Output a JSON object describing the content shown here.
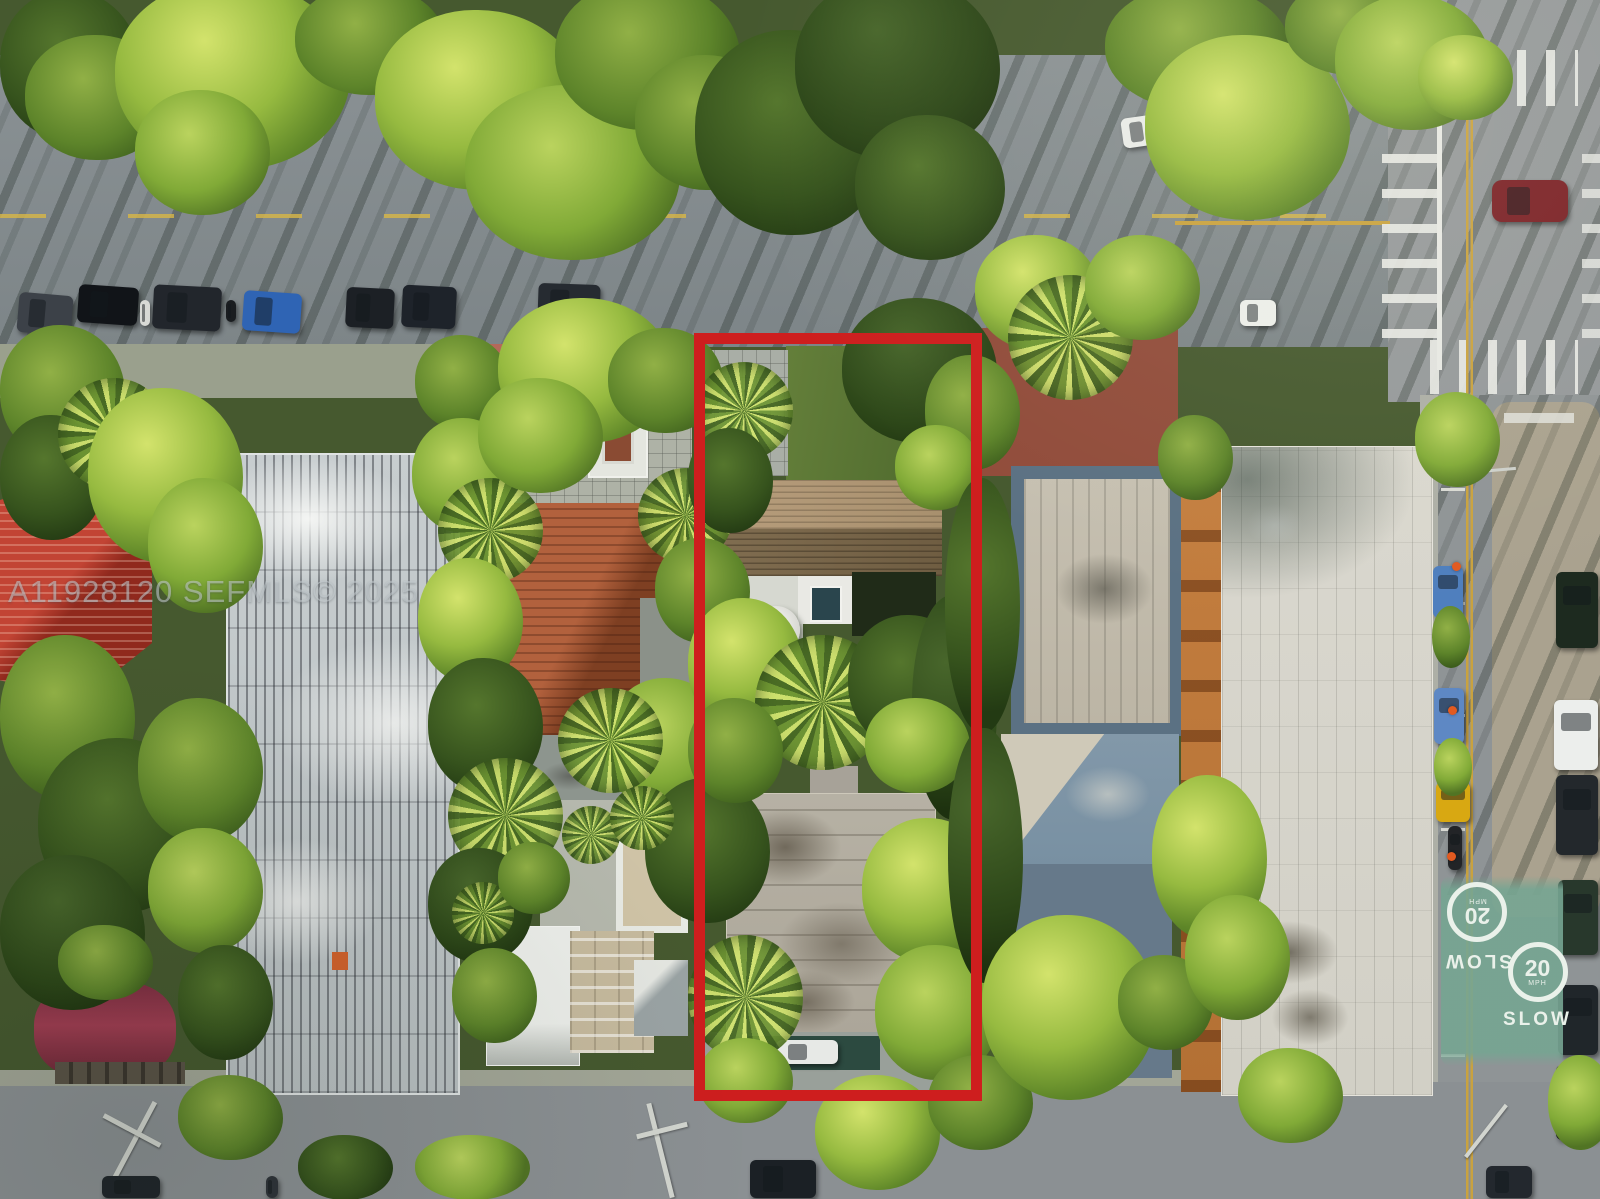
{
  "photo": {
    "kind": "aerial-drone-real-estate-photo",
    "subject": "residential block with featured lot outlined in red"
  },
  "watermark": {
    "text": "A11928120 SEFMLS© 2025"
  },
  "highlight": {
    "outline_color": "#ce1e1e"
  },
  "pavement": {
    "paint_color": "#76a592",
    "center_line_color": "#c9a23f",
    "north": {
      "word": "SLOW",
      "speed": "20",
      "unit": "MPH"
    },
    "south": {
      "word": "SLOW",
      "speed": "20",
      "unit": "MPH"
    }
  }
}
